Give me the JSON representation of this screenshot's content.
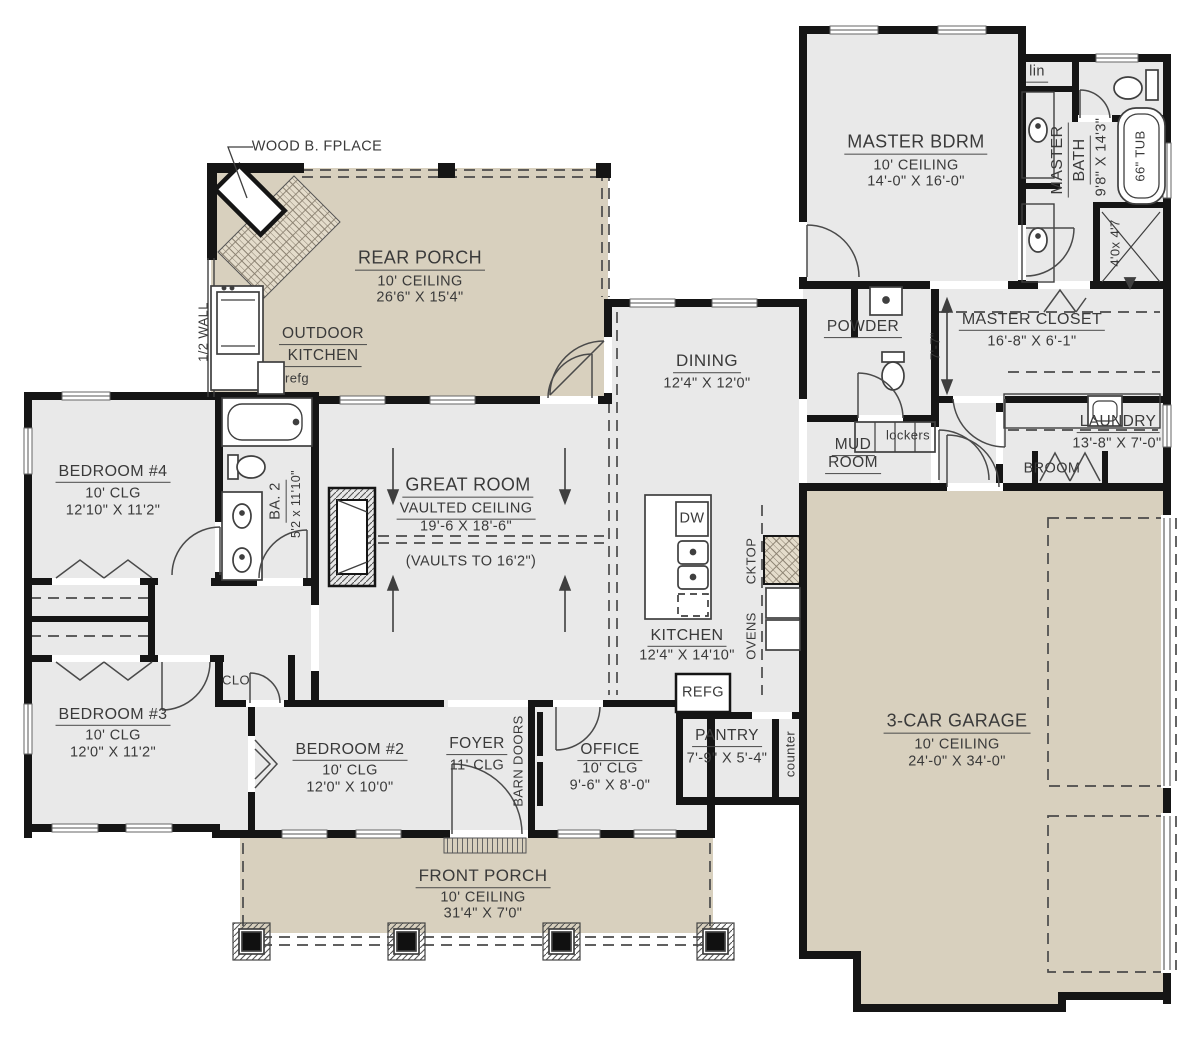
{
  "colors": {
    "interior": "#e9e9e9",
    "porch": "#d8d0be",
    "wall": "#151515",
    "text": "#3a3a3a"
  },
  "rooms": {
    "rear_porch": {
      "name": "REAR PORCH",
      "ceiling": "10' CEILING",
      "dims": "26'6\" X 15'4\""
    },
    "front_porch": {
      "name": "FRONT PORCH",
      "ceiling": "10' CEILING",
      "dims": "31'4\" X 7'0\""
    },
    "garage": {
      "name": "3-CAR GARAGE",
      "ceiling": "10' CEILING",
      "dims": "24'-0\" X 34'-0\""
    },
    "great_room": {
      "name": "GREAT ROOM",
      "ceiling": "VAULTED CEILING",
      "dims": "19'-6 X 18'-6\"",
      "note": "(VAULTS TO 16'2\")"
    },
    "master_bdrm": {
      "name": "MASTER BDRM",
      "ceiling": "10' CEILING",
      "dims": "14'-0\" X 16'-0\""
    },
    "master_bath": {
      "name_l1": "MASTER",
      "name_l2": "BATH",
      "dims": "9'8\" X 14'3\""
    },
    "master_closet": {
      "name": "MASTER CLOSET",
      "dims": "16'-8\" X 6'-1\""
    },
    "powder": {
      "name": "POWDER"
    },
    "mud_room": {
      "name_l1": "MUD",
      "name_l2": "ROOM"
    },
    "laundry": {
      "name": "LAUNDRY",
      "dims": "13'-8\" X 7'-0\""
    },
    "dining": {
      "name": "DINING",
      "dims": "12'4\" X 12'0\""
    },
    "kitchen": {
      "name": "KITCHEN",
      "dims": "12'4\" X 14'10\""
    },
    "pantry": {
      "name": "PANTRY",
      "dims": "7'-9\" X 5'-4\""
    },
    "bedroom2": {
      "name": "BEDROOM #2",
      "ceiling": "10' CLG",
      "dims": "12'0\" X 10'0\""
    },
    "bedroom3": {
      "name": "BEDROOM #3",
      "ceiling": "10' CLG",
      "dims": "12'0\" X 11'2\""
    },
    "bedroom4": {
      "name": "BEDROOM #4",
      "ceiling": "10' CLG",
      "dims": "12'10\" X 11'2\""
    },
    "bath2": {
      "name": "BA. 2",
      "dims": "5'2 x 11'10\""
    },
    "foyer": {
      "name": "FOYER",
      "ceiling": "11' CLG"
    },
    "office": {
      "name": "OFFICE",
      "ceiling": "10' CLG",
      "dims": "9'-6\" X 8'-0\""
    }
  },
  "labels": {
    "wood_fireplace": "WOOD B. FPLACE",
    "half_wall": "1/2 WALL",
    "outdoor_kitchen_l1": "OUTDOOR",
    "outdoor_kitchen_l2": "KITCHEN",
    "outdoor_refg": "refg",
    "linen": "lin",
    "tub": "66\" TUB",
    "shower": "4'0x 4'7",
    "hall_dim": "7'-7\"",
    "lockers": "lockers",
    "broom": "BROOM",
    "dishwasher": "DW",
    "cooktop": "CKTOP",
    "ovens": "OVENS",
    "refrigerator": "REFG",
    "counter": "counter",
    "closet": "CLO",
    "barn_doors": "BARN DOORS"
  }
}
